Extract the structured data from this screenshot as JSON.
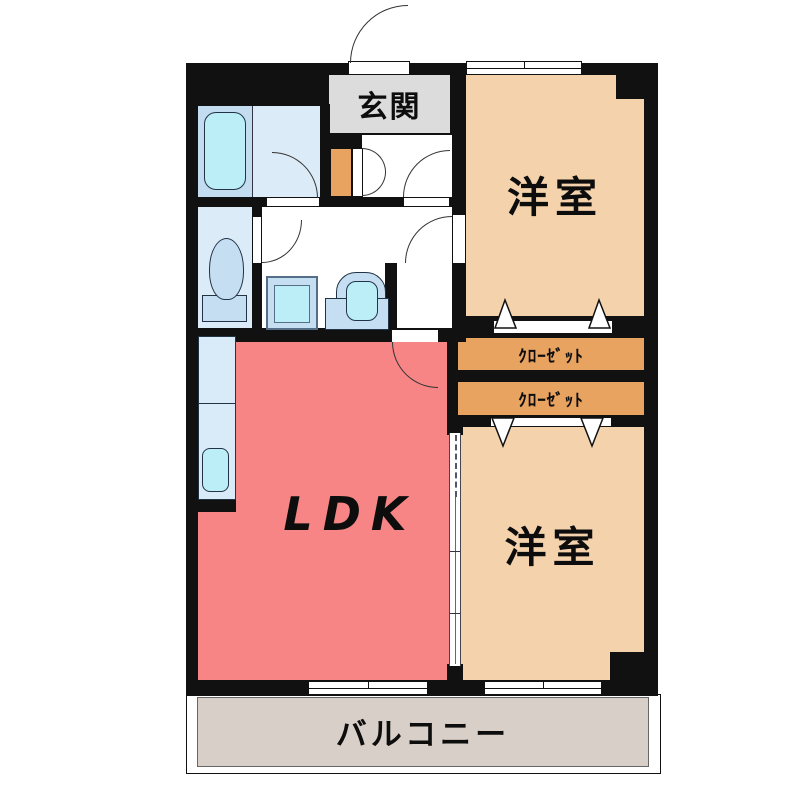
{
  "plan": {
    "type": "apartment-floor-plan",
    "labels": {
      "entrance": "玄関",
      "western_room_top": "洋室",
      "western_room_bottom": "洋室",
      "closet_top": "ｸﾛｰｾﾞｯﾄ",
      "closet_bottom": "ｸﾛｰｾﾞｯﾄ",
      "ldk": "LDK",
      "balcony": "バルコニー"
    },
    "colors": {
      "wall": "#111111",
      "western_room": "#f4d2ac",
      "closet": "#e9a360",
      "ldk": "#f78585",
      "entrance_floor": "#dcdcdc",
      "balcony_floor": "#d8d0c8",
      "bath_floor": "#c3dcf0",
      "sanitary_floor": "#dcebf8",
      "fixture_fill": "#c5def2",
      "water_fill": "#bceef8"
    }
  }
}
